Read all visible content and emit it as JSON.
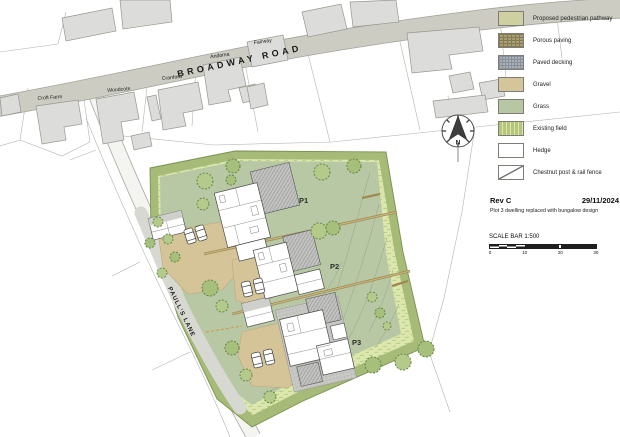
{
  "map_labels": {
    "broadway_road": "BROADWAY ROAD",
    "paulls_lane": "PAULL'S LANE",
    "croft_farm": "Croft Farm",
    "woodcote": "Woodcote",
    "cranford": "Cranford",
    "andoma": "Andoma",
    "fairway": "Fairway"
  },
  "plots": [
    {
      "label": "P1"
    },
    {
      "label": "P2"
    },
    {
      "label": "P3"
    }
  ],
  "north": {
    "label": "N"
  },
  "legend": {
    "items": [
      {
        "label": "Proposed pedestrian pathway",
        "swatch": "pathway",
        "color": "#ced0a2"
      },
      {
        "label": "Porous paving",
        "swatch": "porous",
        "color": "#a89e73"
      },
      {
        "label": "Paved decking",
        "swatch": "decking",
        "color": "#aab0b8"
      },
      {
        "label": "Gravel",
        "swatch": "gravel",
        "color": "#d5c59a"
      },
      {
        "label": "Grass",
        "swatch": "grass",
        "color": "#b7c7a3"
      },
      {
        "label": "Existing field",
        "swatch": "field",
        "color": "#dce8ab"
      },
      {
        "label": "Hedge",
        "swatch": "hedge",
        "color": "#ffffff"
      },
      {
        "label": "Chestnut post & rail fence",
        "swatch": "fence",
        "color": "#ffffff"
      }
    ]
  },
  "revision": {
    "rev": "Rev C",
    "date": "29/11/2024",
    "note": "Plot 3 dwelling replaced with bungalow design"
  },
  "scale_bar": {
    "title": "SCALE BAR 1:500",
    "ticks": [
      "0",
      "10",
      "20",
      "30"
    ]
  },
  "colors": {
    "road": "#ccccc3",
    "building": "#dcdcda",
    "hedge_band": "#a6bb77",
    "existing_field": "#dbe7ad",
    "grass": "#b8c8a4",
    "gravel": "#d4c498",
    "tree": "#b3ca8a",
    "fence_line": "#a18a50"
  }
}
